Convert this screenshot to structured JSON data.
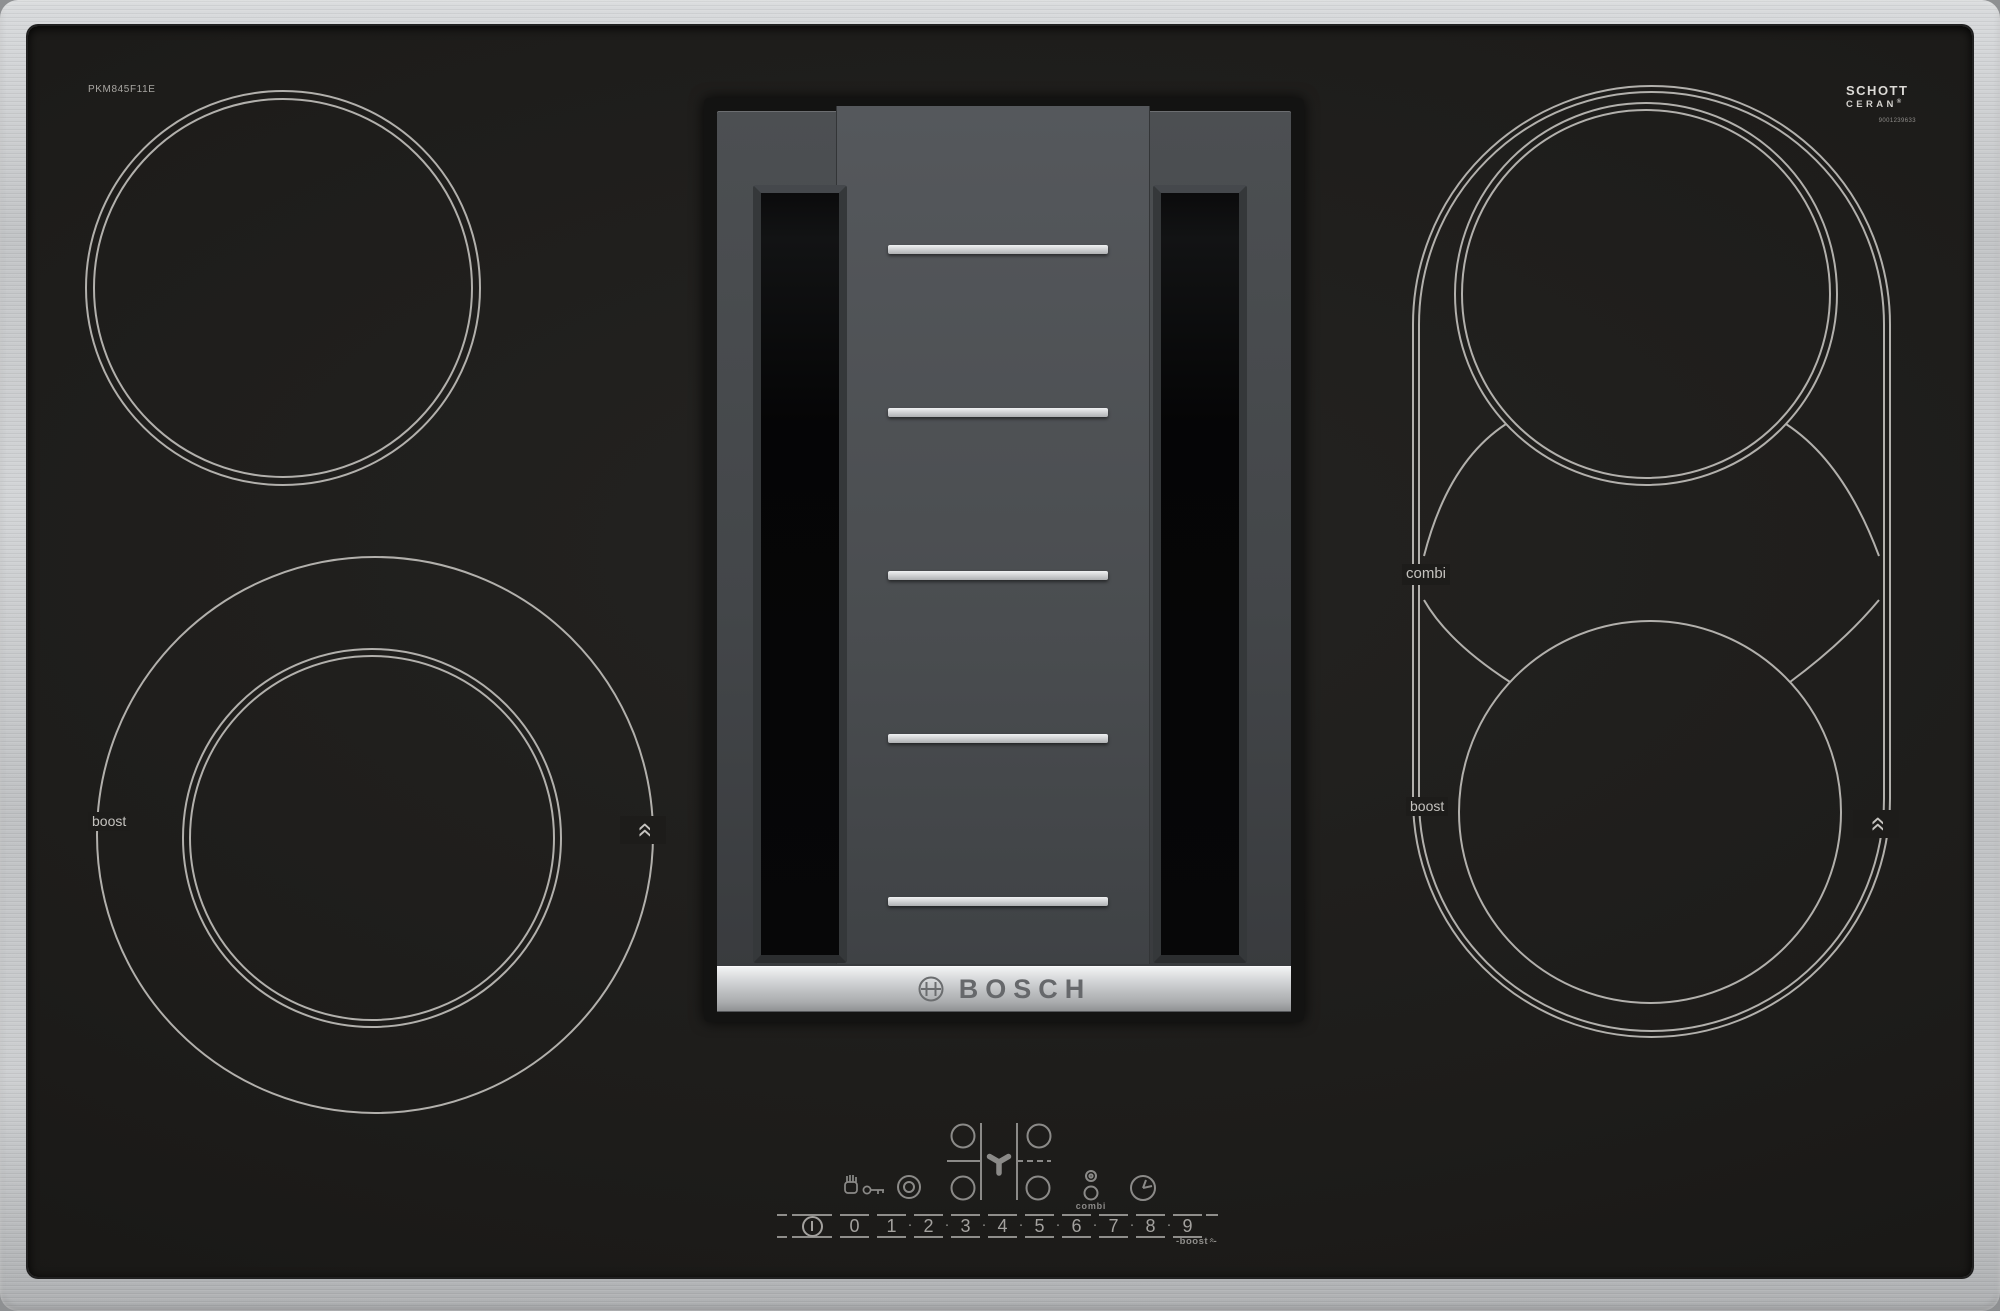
{
  "product": {
    "model": "PKM845F11E",
    "brand": "BOSCH",
    "glass_brand_top": "SCHOTT",
    "glass_brand_bottom": "CERAN",
    "registered_mark": "®",
    "serial": "9001239633"
  },
  "glass_labels": {
    "front_left_boost": "boost",
    "right_combi": "combi",
    "right_boost": "boost",
    "chevron_glyph": "»"
  },
  "controls": {
    "levels": [
      "0",
      "1",
      "2",
      "3",
      "4",
      "5",
      "6",
      "7",
      "8",
      "9"
    ],
    "separator": "·",
    "boost_dash": "-",
    "boost_hint": "boost",
    "combi_button": "combi",
    "icons": {
      "left_icons": [
        "hand-key-lock-icon",
        "double-ring-icon"
      ],
      "center_icon": "fan-icon",
      "right_icons": [
        "combi-zones-icon",
        "timer-clock-icon"
      ],
      "power_icon": "power-icon"
    }
  },
  "colors": {
    "frame_steel": "#cfd1d3",
    "glass_black": "#1d1c1a",
    "zone_ring": "#b2b0ac",
    "control_gray": "#8b8a88",
    "vent_body": "#4a4d50",
    "grille_bar": "#d9dbdc"
  }
}
